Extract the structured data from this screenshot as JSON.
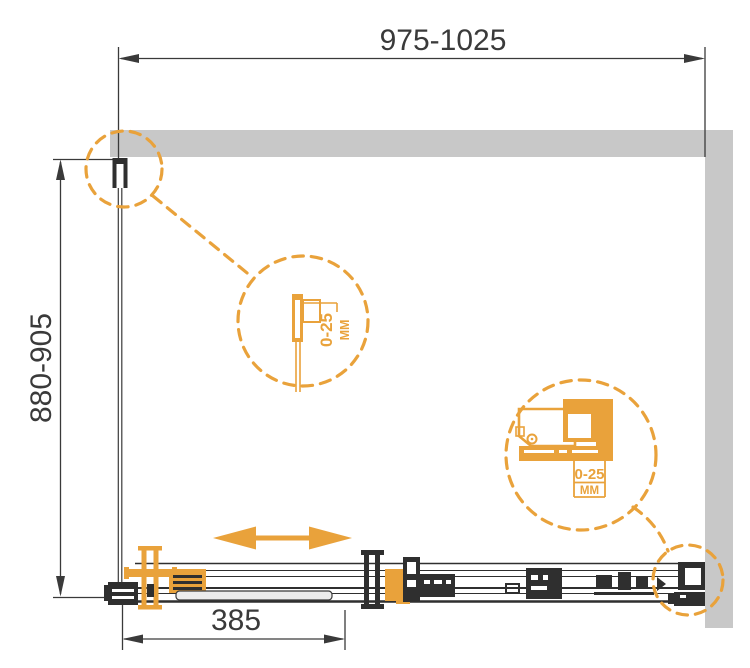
{
  "labels": {
    "width_range": "975-1025",
    "depth_range": "880-905",
    "fixed_segment": "385",
    "detail_mid": {
      "value": "0-25",
      "unit": "ММ"
    },
    "detail_right": {
      "value": "0-25",
      "unit": "ММ"
    }
  },
  "icons": {
    "slide_direction": "double-headed-arrow",
    "detail_callouts": "dashed-magnifier-circles"
  },
  "colors": {
    "accent_orange": "#e9a23b",
    "line_dark": "#3a3a3a",
    "fill_black": "#2f2f2f",
    "wall_gray": "#c8c8c8",
    "panel_gray": "#ececec",
    "background": "#ffffff"
  }
}
